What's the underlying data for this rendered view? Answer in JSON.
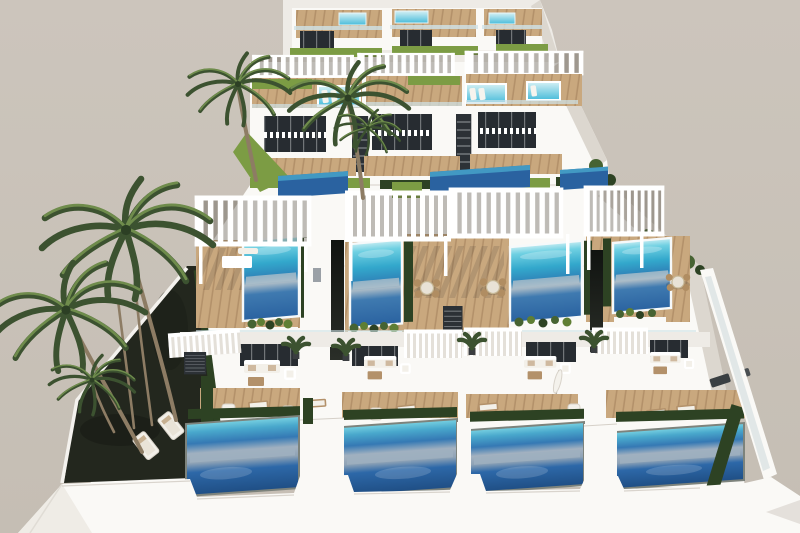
{
  "scene": {
    "type": "architectural-render",
    "description": "Aerial 3D architectural rendering of a modern terraced white villa complex: four stepped rows of flat-roofed villas with rooftop plunge pools, large private pools on wooden sun decks, white slatted pergolas, glass balustrades, green hedges and lawns, outdoor lounge and dining furniture, and tall palm trees against a plain taupe sky.",
    "time_of_day": "day",
    "style": "modern Mediterranean resort",
    "palette": {
      "sky": "#c9c2b9",
      "sky_top": "#ccc5bc",
      "sky_bottom": "#c5beb4",
      "building_white": "#faf9f6",
      "building_shade": "#eeebe6",
      "face_shadow": "#dcd7cf",
      "deep_shadow": "#c2bcb4",
      "glass": "#272c31",
      "deck_wood": "#c9a87e",
      "deck_wood_dark": "#b3916a",
      "lawn": "#7c9c44",
      "lawn_dark": "#5f7e34",
      "hedge": "#2d4223",
      "hedge_light": "#466332",
      "garden_dark": "#23271e",
      "palm_frond_dark": "#3c5230",
      "palm_frond_light": "#6f8c4c",
      "palm_trunk": "#8d7c64",
      "pool_cyan": "#49bcda",
      "pool_deep": "#2a62a0",
      "pool_ground_deep": "#1f4e84",
      "pool_gray": "#a4b2c0",
      "wicker": "#b08d62",
      "cushion": "#f3f0e9",
      "balustrade_glass": "#cfe2e8"
    },
    "elements": {
      "villa_rows": 4,
      "rooftop_pools": 3,
      "upper_tier_pools": 3,
      "middle_tier_pools": 4,
      "ground_pools": 4,
      "pergolas": 7,
      "palm_canopies": 6,
      "sun_loungers": 14,
      "dining_sets": 3,
      "sofa_sets": 4
    }
  }
}
